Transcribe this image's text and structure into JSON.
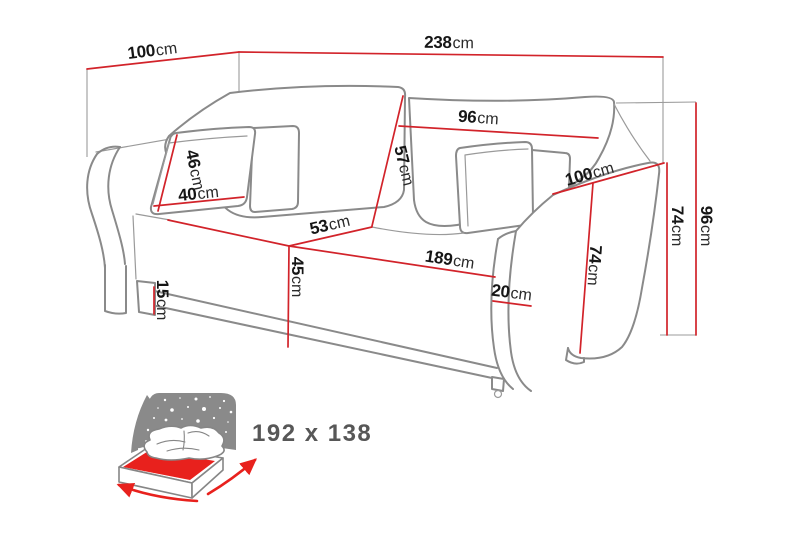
{
  "diagram": {
    "type": "sofa-bed-dimension-diagram",
    "dimensions": {
      "depth_top": {
        "value": "100",
        "unit": "cm"
      },
      "width_total": {
        "value": "238",
        "unit": "cm"
      },
      "back_cushion_width": {
        "value": "96",
        "unit": "cm"
      },
      "back_cushion_height": {
        "value": "57",
        "unit": "cm"
      },
      "pillow_height": {
        "value": "46",
        "unit": "cm"
      },
      "pillow_width": {
        "value": "40",
        "unit": "cm"
      },
      "seat_depth": {
        "value": "53",
        "unit": "cm"
      },
      "seat_length": {
        "value": "189",
        "unit": "cm"
      },
      "seat_height": {
        "value": "45",
        "unit": "cm"
      },
      "leg_height": {
        "value": "15",
        "unit": "cm"
      },
      "armrest_width": {
        "value": "20",
        "unit": "cm"
      },
      "armrest_depth": {
        "value": "100",
        "unit": "cm"
      },
      "armrest_height_front": {
        "value": "74",
        "unit": "cm"
      },
      "armrest_height_side": {
        "value": "74",
        "unit": "cm"
      },
      "total_height": {
        "value": "96",
        "unit": "cm"
      }
    },
    "sleeping_area": {
      "icon": "sofa-bed-sleeping-area-icon",
      "label": "192 x 138"
    },
    "colors": {
      "dimension_line": "#d2232a",
      "outline": "#8a8a8a",
      "label_text": "#161616",
      "icon_panel_gray": "#8a8a8a",
      "icon_red": "#e8211d",
      "icon_text_gray": "#575757"
    }
  }
}
